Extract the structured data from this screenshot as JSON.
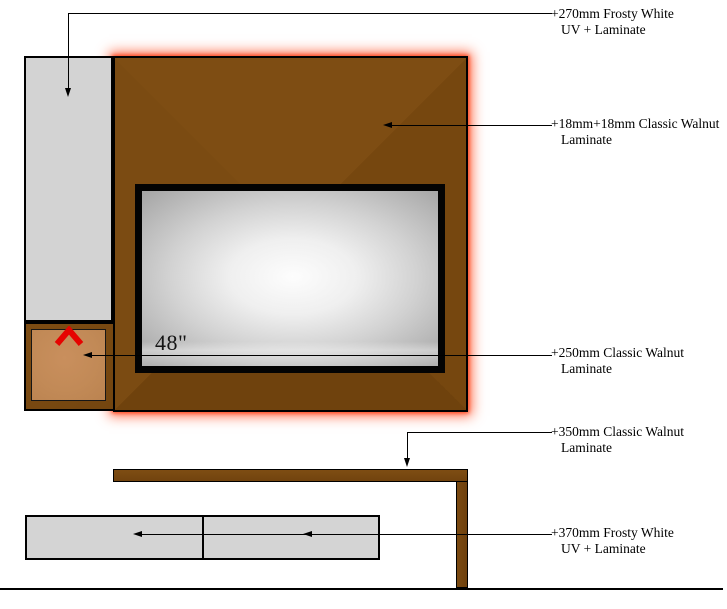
{
  "diagram": {
    "title": "TV unit laminate specification drawing",
    "tv": {
      "size_label": "48\""
    },
    "annotations": [
      {
        "line1": "+270mm Frosty White",
        "line2": "UV + Laminate"
      },
      {
        "line1": "+18mm+18mm Classic Walnut",
        "line2": "Laminate"
      },
      {
        "line1": "+250mm Classic Walnut",
        "line2": "Laminate"
      },
      {
        "line1": "+350mm Classic Walnut",
        "line2": "Laminate"
      },
      {
        "line1": "+370mm Frosty White",
        "line2": "UV + Laminate"
      }
    ],
    "colors": {
      "walnut_brown": "#7a4a11",
      "drawer_tan": "#c28a57",
      "panel_gray": "#d3d3d3",
      "glow_orange_red": "#ff3e16",
      "chevron_red": "#e60300",
      "tv_frame_black": "#030303",
      "line_black": "#000000"
    },
    "icons": [
      "chevron-up-icon",
      "arrow-left-icon",
      "arrow-down-icon"
    ]
  }
}
